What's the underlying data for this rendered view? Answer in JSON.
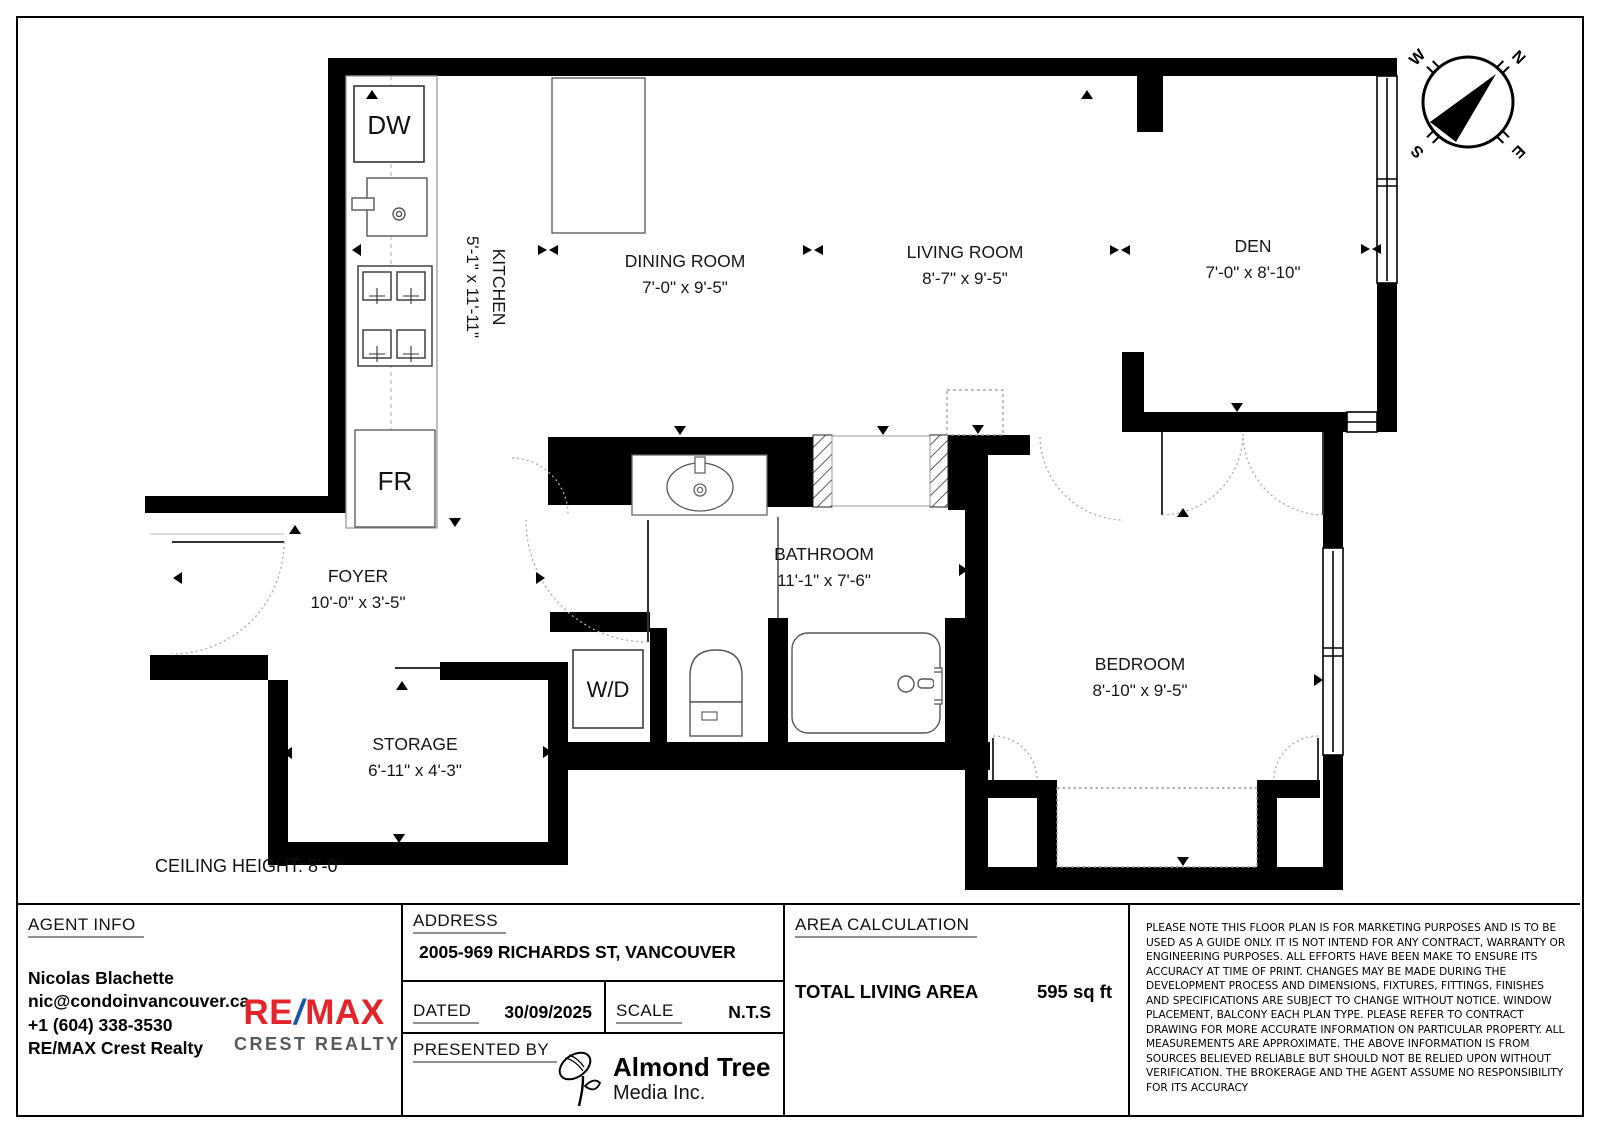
{
  "floor_plan": {
    "rooms": {
      "kitchen": {
        "name": "KITCHEN",
        "dims": "5'-1\" x 11'-11\""
      },
      "dining": {
        "name": "DINING ROOM",
        "dims": "7'-0\" x 9'-5\""
      },
      "living": {
        "name": "LIVING ROOM",
        "dims": "8'-7\" x 9'-5\""
      },
      "den": {
        "name": "DEN",
        "dims": "7'-0\" x 8'-10\""
      },
      "foyer": {
        "name": "FOYER",
        "dims": "10'-0\" x 3'-5\""
      },
      "bathroom": {
        "name": "BATHROOM",
        "dims": "11'-1\" x 7'-6\""
      },
      "storage": {
        "name": "STORAGE",
        "dims": "6'-11\" x 4'-3\""
      },
      "bedroom": {
        "name": "BEDROOM",
        "dims": "8'-10\" x 9'-5\""
      }
    },
    "fixtures": {
      "dishwasher": "DW",
      "fridge": "FR",
      "washer_dryer": "W/D"
    },
    "ceiling_height": "CEILING HEIGHT: 8'-0\"",
    "compass": {
      "n": "N",
      "e": "E",
      "s": "S",
      "w": "W"
    }
  },
  "info_panel": {
    "agent": {
      "header": "AGENT INFO",
      "name": "Nicolas Blachette",
      "email": "nic@condoinvancouver.ca",
      "phone": "+1 (604) 338-3530",
      "brokerage": "RE/MAX Crest Realty"
    },
    "remax_logo": {
      "re": "RE",
      "slash": "/",
      "max": "MAX",
      "sub": "CREST REALTY",
      "red": "#e3252b",
      "blue": "#1558a7",
      "gray": "#565a5c"
    },
    "address": {
      "header": "ADDRESS",
      "value": "2005-969 RICHARDS ST, VANCOUVER"
    },
    "dated": {
      "header": "DATED",
      "value": "30/09/2025"
    },
    "scale": {
      "header": "SCALE",
      "value": "N.T.S"
    },
    "presented_by": {
      "header": "PRESENTED BY",
      "company_name": "Almond Tree",
      "company_sub": "Media Inc."
    },
    "area_calculation": {
      "header": "AREA CALCULATION",
      "label": "TOTAL LIVING AREA",
      "value": "595 sq ft"
    },
    "disclaimer": "PLEASE NOTE THIS FLOOR PLAN IS FOR MARKETING PURPOSES AND IS TO BE USED AS A GUIDE ONLY. IT IS NOT INTEND FOR ANY CONTRACT, WARRANTY OR ENGINEERING PURPOSES. ALL EFFORTS HAVE BEEN MAKE TO ENSURE ITS ACCURACY AT TIME OF PRINT. CHANGES MAY BE MADE DURING THE DEVELOPMENT PROCESS AND DIMENSIONS, FIXTURES, FITTINGS, FINISHES AND SPECIFICATIONS ARE SUBJECT TO CHANGE WITHOUT NOTICE. WINDOW PLACEMENT, BALCONY EACH PLAN TYPE. PLEASE REFER TO CONTRACT DRAWING FOR MORE ACCURATE INFORMATION ON PARTICULAR PROPERTY. ALL MEASUREMENTS ARE APPROXIMATE. THE ABOVE INFORMATION IS FROM SOURCES BELIEVED RELIABLE BUT SHOULD NOT BE RELIED UPON WITHOUT VERIFICATION. THE BROKERAGE AND THE AGENT ASSUME NO RESPONSIBILITY FOR ITS ACCURACY"
  }
}
